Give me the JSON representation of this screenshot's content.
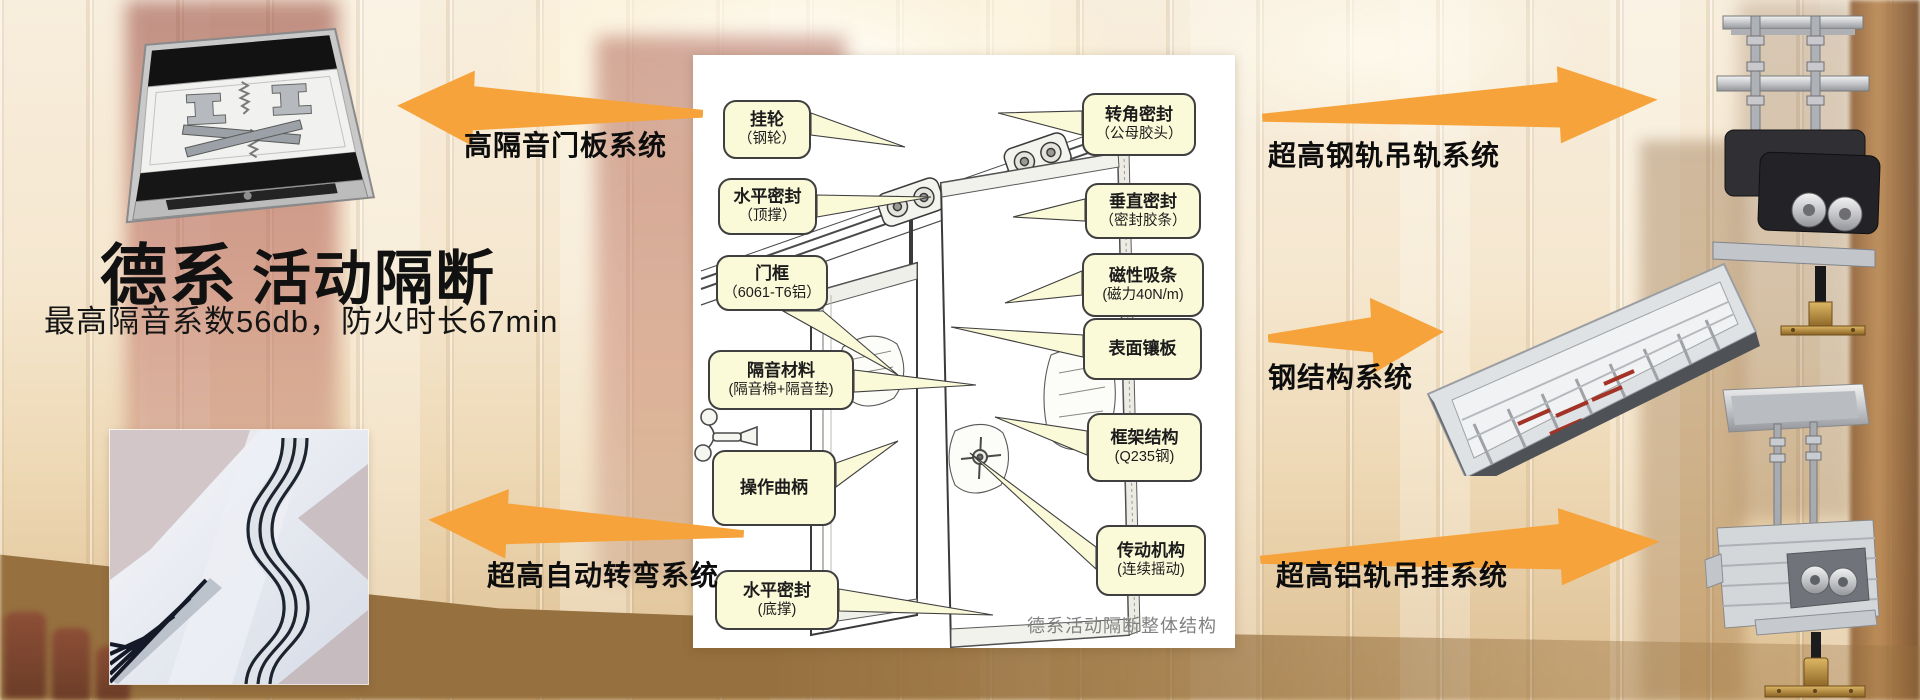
{
  "header": {
    "title_primary": "德系",
    "title_secondary": "活动隔断",
    "subtitle": "最高隔音系数56db，防火时长67min"
  },
  "labels": {
    "left_top": "高隔音门板系统",
    "left_bottom": "超高自动转弯系统",
    "right_top": "超高钢轨吊轨系统",
    "right_middle": "钢结构系统",
    "right_bottom": "超高铝轨吊挂系统"
  },
  "diagram": {
    "caption": "德系活动隔断整体结构",
    "left_callouts": [
      {
        "title": "挂轮",
        "detail": "（钢轮）"
      },
      {
        "title": "水平密封",
        "detail": "（顶撑）"
      },
      {
        "title": "门框",
        "detail": "（6061-T6铝）"
      },
      {
        "title": "隔音材料",
        "detail": "(隔音棉+隔音垫)"
      },
      {
        "title": "操作曲柄",
        "detail": ""
      },
      {
        "title": "水平密封",
        "detail": "(底撑)"
      }
    ],
    "right_callouts": [
      {
        "title": "转角密封",
        "detail": "（公母胶头）"
      },
      {
        "title": "垂直密封",
        "detail": "（密封胶条）"
      },
      {
        "title": "磁性吸条",
        "detail": "(磁力40N/m)"
      },
      {
        "title": "表面镶板",
        "detail": ""
      },
      {
        "title": "框架结构",
        "detail": "(Q235钢)"
      },
      {
        "title": "传动机构",
        "detail": "(连续摇动)"
      }
    ]
  },
  "colors": {
    "arrow_orange": "#F6A33C",
    "callout_fill": "#FAF9D8",
    "callout_border": "#3F3F3F",
    "text_dark": "#111111",
    "caption_gray": "#808080"
  }
}
